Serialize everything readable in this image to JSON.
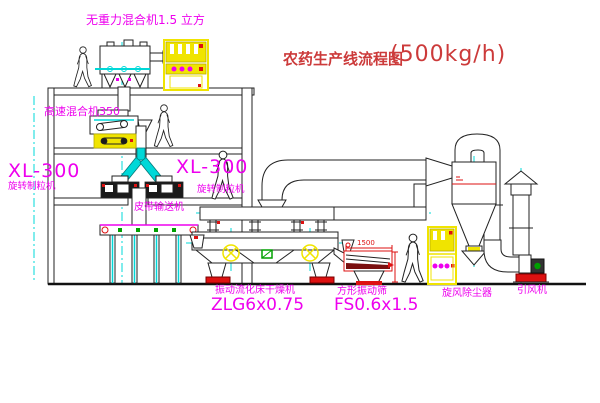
{
  "title": {
    "text": "农药生产线流程图",
    "capacity": "(500kg/h)"
  },
  "labels": {
    "gravity_mixer": "无重力混合机1.5 立方",
    "high_speed_mixer": "高速混合机350",
    "granulator_left_model": "XL-300",
    "granulator_left_name": "旋转制粒机",
    "granulator_mid_model": "XL-300",
    "granulator_mid_name": "旋转制粒机",
    "belt_conveyor": "皮带输送机",
    "dryer_name": "振动流化床干燥机",
    "dryer_model": "ZLG6x0.75",
    "sieve_name": "方形振动筛",
    "sieve_model": "FS0.6x1.5",
    "cyclone": "旋风除尘器",
    "fan": "引风机"
  },
  "dimensions": {
    "sieve_width": "1500"
  },
  "colors": {
    "label_magenta": "#ee00ee",
    "title_red": "#cc3a3a",
    "line_black": "#222222",
    "accent_cyan": "#00d8d8",
    "accent_yellow": "#f0e400",
    "accent_red": "#dd1111",
    "accent_green": "#00a000"
  }
}
